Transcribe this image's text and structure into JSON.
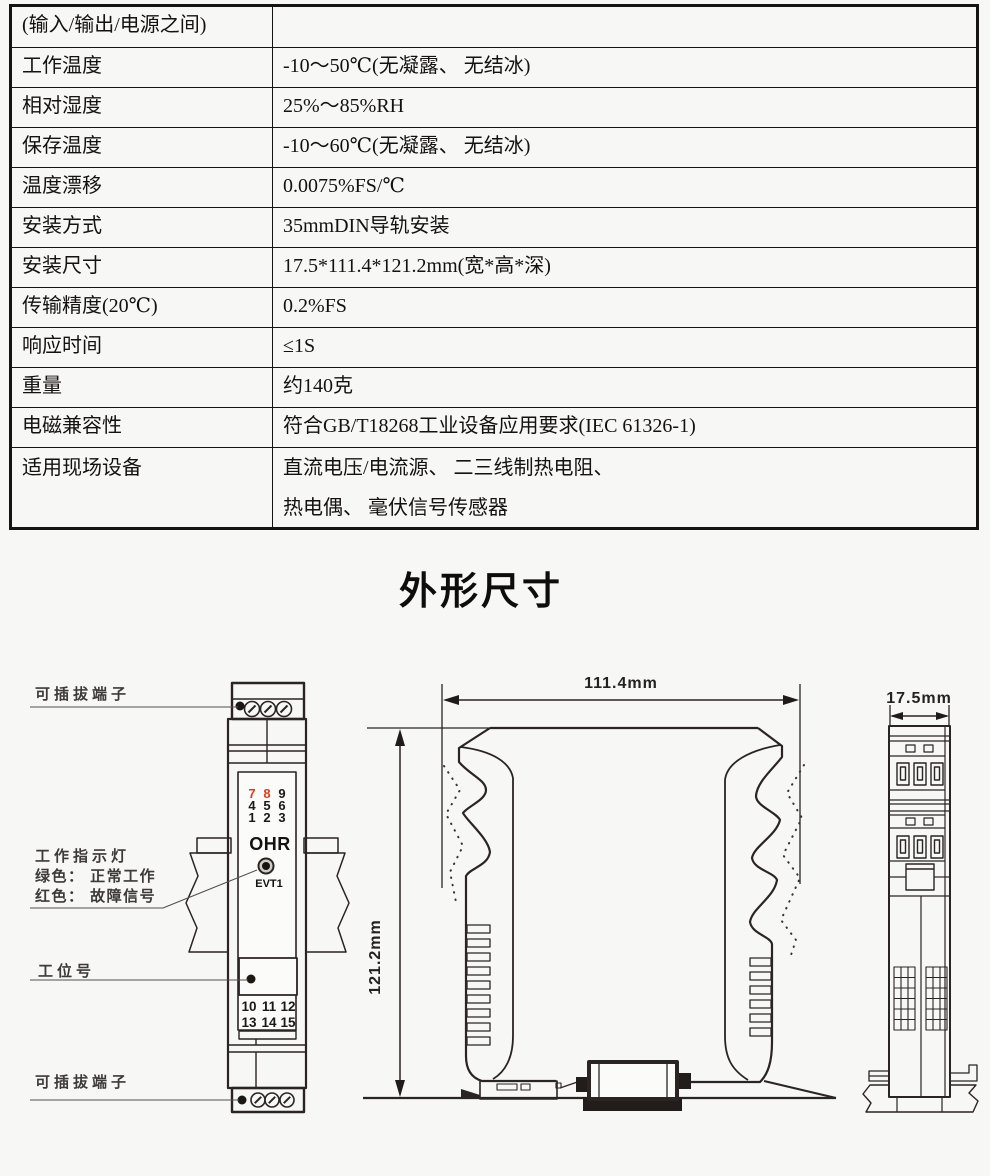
{
  "spec_table": {
    "rows": [
      {
        "label": "(输入/输出/电源之间)",
        "value": ""
      },
      {
        "label": "工作温度",
        "value": "-10～50℃(无凝露、 无结冰)"
      },
      {
        "label": "相对湿度",
        "value": "25%～85%RH"
      },
      {
        "label": "保存温度",
        "value": "-10～60℃(无凝露、 无结冰)"
      },
      {
        "label": "温度漂移",
        "value": "0.0075%FS/℃"
      },
      {
        "label": "安装方式",
        "value": "35mmDIN导轨安装"
      },
      {
        "label": "安装尺寸",
        "value": "17.5*111.4*121.2mm(宽*高*深)"
      },
      {
        "label": "传输精度(20℃)",
        "value": "0.2%FS"
      },
      {
        "label": "响应时间",
        "value": "≤1S"
      },
      {
        "label": "重量",
        "value": "约140克"
      },
      {
        "label": "电磁兼容性",
        "value": "符合GB/T18268工业设备应用要求(IEC 61326-1)"
      },
      {
        "label": "适用现场设备",
        "value": "直流电压/电流源、 二三线制热电阻、",
        "value2": "热电偶、 毫伏信号传感器"
      }
    ]
  },
  "section": {
    "title": "外形尺寸"
  },
  "diagram": {
    "labels": {
      "terminal_top": "可插拔端子",
      "indicator_title": "工作指示灯",
      "indicator_green": "绿色： 正常工作",
      "indicator_red": "红色： 故障信号",
      "station_tag": "工位号",
      "terminal_bottom": "可插拔端子"
    },
    "front_view": {
      "top_numbers": [
        "7",
        "8",
        "9",
        "4",
        "5",
        "6",
        "1",
        "2",
        "3"
      ],
      "logo": "OHR",
      "led_label": "EVT1",
      "bottom_numbers": [
        "10",
        "11",
        "12",
        "13",
        "14",
        "15"
      ]
    },
    "dimensions": {
      "width": "111.4mm",
      "height": "121.2mm",
      "depth": "17.5mm"
    },
    "colors": {
      "red_terminal": "#e23a1c",
      "line": "#2a2422"
    }
  }
}
